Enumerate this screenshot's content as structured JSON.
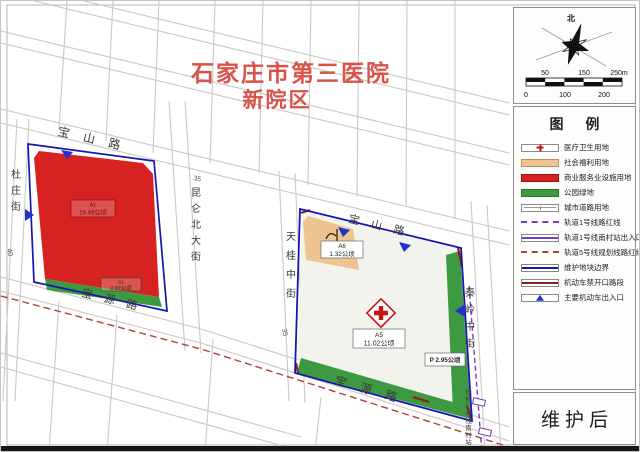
{
  "title": {
    "line1": "石家庄市第三医院",
    "line2": "新院区"
  },
  "map": {
    "roads": {
      "baoshan": "宝山路",
      "baoyuan": "宝源路",
      "duzhuang": "杜庄街",
      "kunlun": "昆仑北大街",
      "tiangui": "天桂中街",
      "qinling": "秦岭中街"
    },
    "road_widths": {
      "top": "35",
      "left": "40",
      "mid": "35"
    },
    "parcels": {
      "commercial": {
        "code": "A1",
        "area": "16.49公顷"
      },
      "park_west": {
        "code": "G1",
        "area": "0.97公顷"
      },
      "welfare": {
        "code": "A6",
        "area": "1.32公顷"
      },
      "medical": {
        "code": "A5",
        "area": "11.02公顷"
      },
      "parking": {
        "label": "P 2.95公顷"
      }
    },
    "station_label": "地铁1号线南村站"
  },
  "compass": {
    "north": "北",
    "scale": {
      "top": [
        "50",
        "150",
        "250m"
      ],
      "bottom": [
        "0",
        "100",
        "200"
      ]
    }
  },
  "legend": {
    "title": "图 例",
    "items": [
      {
        "label": "医疗卫生用地",
        "type": "medical"
      },
      {
        "label": "社会福利用地",
        "type": "welfare"
      },
      {
        "label": "商业服务业设施用地",
        "type": "commercial"
      },
      {
        "label": "公园绿地",
        "type": "park"
      },
      {
        "label": "城市道路用地",
        "type": "road"
      },
      {
        "label": "轨道1号线路红线",
        "type": "rail1-dashed"
      },
      {
        "label": "轨道1号线南村站出入口",
        "type": "rail1-solid"
      },
      {
        "label": "轨道5号线规划线路红线",
        "type": "rail5-dashed"
      },
      {
        "label": "维护地块边界",
        "type": "boundary"
      },
      {
        "label": "机动车禁开口路段",
        "type": "no-open"
      },
      {
        "label": "主要机动车出入口",
        "type": "entrance"
      }
    ]
  },
  "status": {
    "label": "维护后"
  },
  "colors": {
    "medical_fill": "#f3f3ed",
    "welfare_fill": "#eec591",
    "commercial_fill": "#d62322",
    "park_fill": "#3e9a40",
    "boundary_blue": "#1717b0",
    "rail1_purple": "#7a3cc0",
    "rail5_red": "#b04038",
    "no_open_red": "#8b1f1f",
    "entrance_blue": "#2233cc",
    "title_red": "#d9534a"
  }
}
